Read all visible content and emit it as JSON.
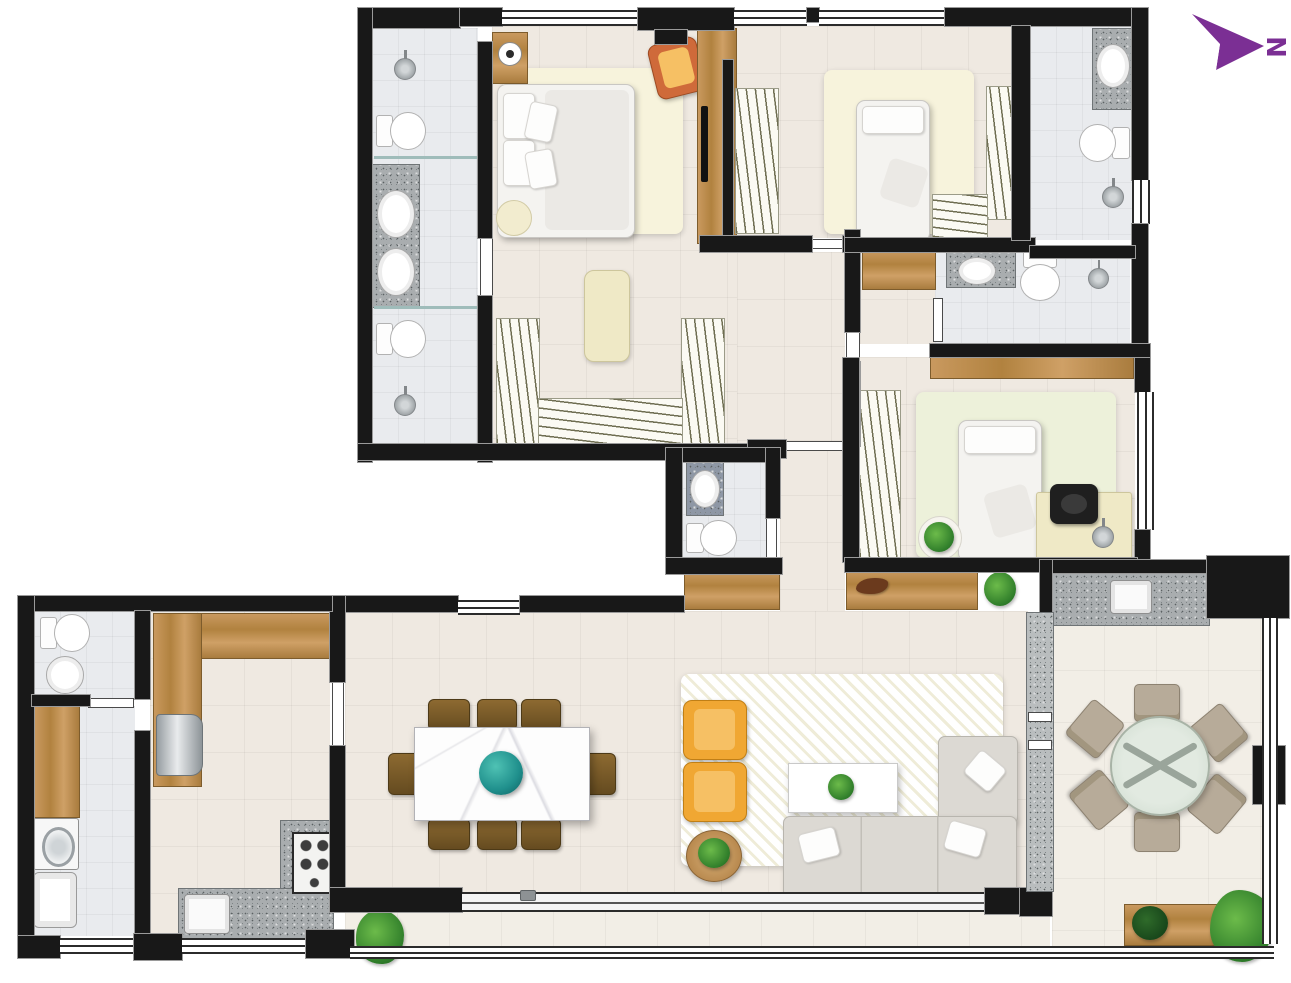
{
  "document": {
    "kind": "furnished apartment floor plan, top-down architectural rendering",
    "visible_text": "none (graphics only, plus compass letter)"
  },
  "north_arrow": {
    "label": "N",
    "color": "#7b2f94",
    "direction": "pointing right, letter drawn rotated 90°"
  },
  "palette": {
    "wall": "#181818",
    "wall_outline": "#9a9a9a",
    "wood": "#c2924f",
    "granite": "#a9adaf",
    "floor_tile": "#efe9e1",
    "bath_tile": "#e9ebee",
    "balcony_tile": "#f2eee6",
    "rug_cream": "#f7f3dc",
    "rug_geometric_white": "#fbf9ee",
    "rug_green_tint": "#edf1da",
    "sofa_grey": "#dcd9d3",
    "armchair_yellow": "#f0a733",
    "dining_chair_brown": "#755728",
    "terrace_chair_beige": "#b7ab99",
    "centerpiece_teal": "#1f8f8c",
    "plant_green": "#3f9b3f",
    "ottoman_cream": "#efe9c6",
    "glass_partition": "#9fbcba"
  },
  "rooms": [
    {
      "name": "master-bathroom",
      "fixtures": [
        "shower head x2",
        "toilet x2",
        "granite double vanity",
        "oval sink x2",
        "glass partition x2"
      ]
    },
    {
      "name": "master-bedroom",
      "fixtures": [
        "double bed with pillows",
        "nightstand",
        "table lamp",
        "cream rug",
        "round pouf",
        "orange accent chair",
        "wood wardrobe panel with TV"
      ]
    },
    {
      "name": "walk-in-closet",
      "fixtures": [
        "U-shaped hanging wardrobe (hatched)",
        "cream ottoman bench"
      ]
    },
    {
      "name": "bedroom-2",
      "fixtures": [
        "single bed",
        "cream rug",
        "hanging wardrobe left",
        "hanging wardrobe right",
        "hanging wardrobe bottom",
        "window"
      ]
    },
    {
      "name": "bathroom-2",
      "fixtures": [
        "granite vanity with oval sink",
        "toilet",
        "shower head",
        "window"
      ]
    },
    {
      "name": "bathroom-3",
      "fixtures": [
        "granite vanity with oval sink",
        "toilet",
        "shower head",
        "wood cabinet in vestibule"
      ]
    },
    {
      "name": "bedroom-3",
      "fixtures": [
        "single bed",
        "green-tint rug",
        "hanging wardrobe",
        "wood shelf strip",
        "desk",
        "black office chair",
        "desk lamp",
        "potted plant"
      ]
    },
    {
      "name": "powder-room",
      "fixtures": [
        "vanity sink",
        "toilet"
      ]
    },
    {
      "name": "hall-corridor",
      "fixtures": [
        "wood console x2",
        "decor object",
        "floor plant"
      ]
    },
    {
      "name": "living-room",
      "fixtures": [
        "geometric white rug",
        "yellow armchair x2",
        "round wood side table with plant",
        "white coffee table with plant",
        "L-shaped grey sofa with pillows",
        "sliding glass door to balcony"
      ]
    },
    {
      "name": "dining-room",
      "fixtures": [
        "marble dining table",
        "teal centerpiece bowl",
        "wood dining chair x8"
      ]
    },
    {
      "name": "kitchen",
      "fixtures": [
        "L-shaped wood counter",
        "refrigerator",
        "granite counter",
        "kitchen sink",
        "gas cooktop",
        "door to living room"
      ]
    },
    {
      "name": "laundry",
      "fixtures": [
        "wood counter",
        "washing machine",
        "laundry tub"
      ]
    },
    {
      "name": "service-wc",
      "fixtures": [
        "toilet",
        "round sink"
      ]
    },
    {
      "name": "terrace",
      "fixtures": [
        "granite barbecue counter with sink",
        "round glass table with X base",
        "beige chair x6",
        "wood planter with plants",
        "large plant",
        "glass railing",
        "column"
      ]
    },
    {
      "name": "balcony",
      "fixtures": [
        "plant",
        "glass railing",
        "sliding door track"
      ]
    }
  ]
}
